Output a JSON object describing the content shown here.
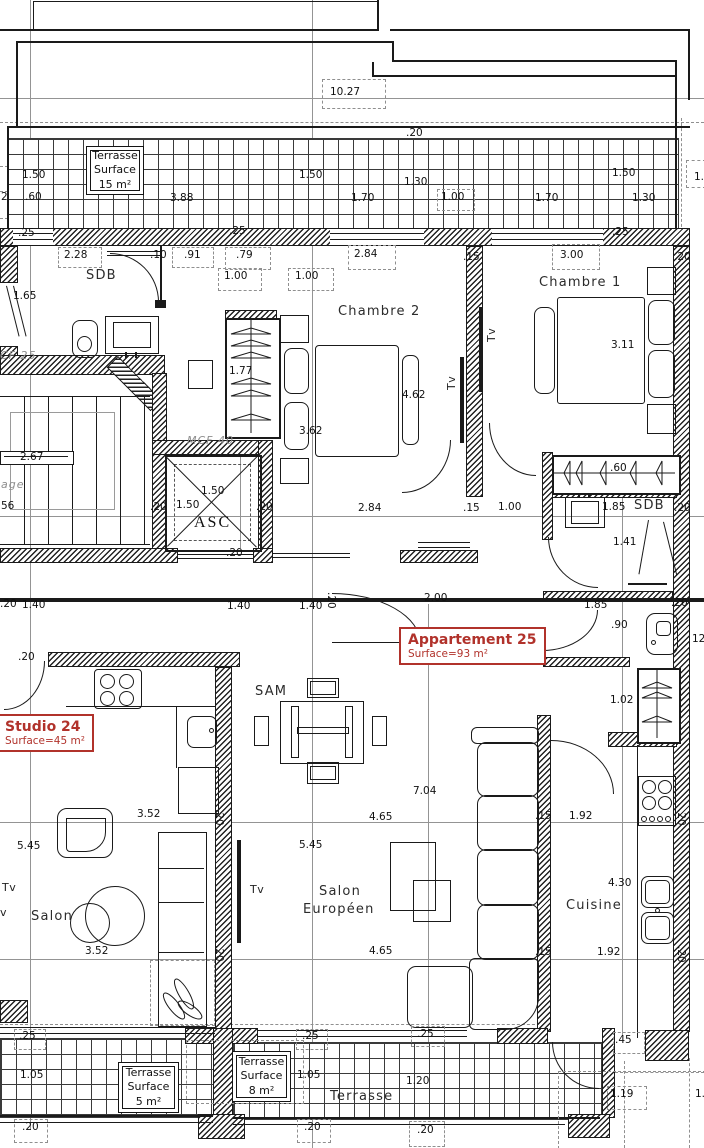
{
  "palette": {
    "line": "#1a1a1a",
    "gray": "#949494",
    "red": "#b1322b"
  },
  "apartments": [
    {
      "name": "Studio 24",
      "surface": "Surface=45 m²"
    },
    {
      "name": "Appartement 25",
      "surface": "Surface=93 m²"
    }
  ],
  "terraces": [
    {
      "name": "Terrasse",
      "surface_label": "Surface",
      "area": "15 m²"
    },
    {
      "name": "Terrasse",
      "surface_label": "Surface",
      "area": "5 m²"
    },
    {
      "name": "Terrasse",
      "surface_label": "Surface",
      "area": "8 m²"
    }
  ],
  "labels": [
    {
      "t": "10.27",
      "x": 330,
      "y": 87
    },
    {
      "t": ".20",
      "x": 406,
      "y": 128
    },
    {
      "t": "1.50",
      "x": 22,
      "y": 170
    },
    {
      "t": "1.50",
      "x": 299,
      "y": 170
    },
    {
      "t": "1.30",
      "x": 404,
      "y": 177
    },
    {
      "t": "1.50",
      "x": 612,
      "y": 168
    },
    {
      "t": "1.",
      "x": 694,
      "y": 172
    },
    {
      "t": "2",
      "x": 1,
      "y": 192
    },
    {
      "t": ".60",
      "x": 25,
      "y": 192
    },
    {
      "t": "3.88",
      "x": 170,
      "y": 193
    },
    {
      "t": "1.70",
      "x": 351,
      "y": 193
    },
    {
      "t": "1.00",
      "x": 441,
      "y": 192
    },
    {
      "t": "1.70",
      "x": 535,
      "y": 193
    },
    {
      "t": "1.30",
      "x": 632,
      "y": 193
    },
    {
      "t": ".25",
      "x": 18,
      "y": 228
    },
    {
      "t": ".25",
      "x": 229,
      "y": 226
    },
    {
      "t": ".25",
      "x": 612,
      "y": 227
    },
    {
      "t": "2.28",
      "x": 64,
      "y": 250
    },
    {
      "t": ".10",
      "x": 150,
      "y": 250
    },
    {
      "t": ".91",
      "x": 184,
      "y": 250
    },
    {
      "t": ".79",
      "x": 236,
      "y": 250
    },
    {
      "t": "2.84",
      "x": 354,
      "y": 249
    },
    {
      "t": "3.00",
      "x": 560,
      "y": 250
    },
    {
      "t": ".15",
      "x": 463,
      "y": 252
    },
    {
      "t": ".20",
      "x": 674,
      "y": 252
    },
    {
      "t": "1.00",
      "x": 224,
      "y": 271
    },
    {
      "t": "1.00",
      "x": 295,
      "y": 271
    },
    {
      "t": "1.65",
      "x": 13,
      "y": 291
    },
    {
      "t": "1.77",
      "x": 229,
      "y": 366
    },
    {
      "t": "3.62",
      "x": 299,
      "y": 426
    },
    {
      "t": "4.62",
      "x": 402,
      "y": 390
    },
    {
      "t": "3.11",
      "x": 611,
      "y": 340
    },
    {
      "t": "2.67",
      "x": 20,
      "y": 452
    },
    {
      "t": "age",
      "x": 1,
      "y": 479,
      "cls": "wall"
    },
    {
      "t": "56",
      "x": 1,
      "y": 501
    },
    {
      "t": "CF 25",
      "x": 0,
      "y": 350,
      "cls": "wall"
    },
    {
      "t": "MCF 40",
      "x": 187,
      "y": 435,
      "cls": "wall"
    },
    {
      "t": "1.50",
      "x": 201,
      "y": 486
    },
    {
      "t": "1.50",
      "x": 176,
      "y": 500
    },
    {
      "t": ".20",
      "x": 150,
      "y": 502
    },
    {
      "t": ".20",
      "x": 256,
      "y": 502
    },
    {
      "t": "2.84",
      "x": 358,
      "y": 503
    },
    {
      "t": ".15",
      "x": 463,
      "y": 503
    },
    {
      "t": "1.00",
      "x": 498,
      "y": 502
    },
    {
      "t": "1.85",
      "x": 602,
      "y": 502
    },
    {
      "t": ".20",
      "x": 674,
      "y": 503
    },
    {
      "t": ".60",
      "x": 610,
      "y": 463
    },
    {
      "t": "1.41",
      "x": 613,
      "y": 537
    },
    {
      "t": ".20",
      "x": 226,
      "y": 548
    },
    {
      "t": ".20",
      "x": 0,
      "y": 599
    },
    {
      "t": "1.40",
      "x": 22,
      "y": 600
    },
    {
      "t": "1.40",
      "x": 227,
      "y": 601
    },
    {
      "t": "1.40",
      "x": 299,
      "y": 601
    },
    {
      "t": ".20",
      "x": 336,
      "y": 592,
      "r": 90
    },
    {
      "t": "2.00",
      "x": 424,
      "y": 593
    },
    {
      "t": "1.85",
      "x": 584,
      "y": 600
    },
    {
      "t": ".20",
      "x": 671,
      "y": 598
    },
    {
      "t": ".90",
      "x": 611,
      "y": 620
    },
    {
      "t": "12",
      "x": 692,
      "y": 634
    },
    {
      "t": "1.02",
      "x": 610,
      "y": 695
    },
    {
      "t": ".20",
      "x": 18,
      "y": 652
    },
    {
      "t": "3.52",
      "x": 137,
      "y": 809
    },
    {
      "t": "5.45",
      "x": 17,
      "y": 841
    },
    {
      "t": "5.45",
      "x": 299,
      "y": 840
    },
    {
      "t": "7.04",
      "x": 413,
      "y": 786
    },
    {
      "t": "4.65",
      "x": 369,
      "y": 812
    },
    {
      "t": ".15",
      "x": 535,
      "y": 811
    },
    {
      "t": "1.92",
      "x": 569,
      "y": 811
    },
    {
      "t": ".20",
      "x": 686,
      "y": 809,
      "r": 90
    },
    {
      "t": "3.52",
      "x": 85,
      "y": 946
    },
    {
      "t": "4.65",
      "x": 369,
      "y": 946
    },
    {
      "t": ".15",
      "x": 535,
      "y": 947
    },
    {
      "t": "1.92",
      "x": 597,
      "y": 947
    },
    {
      "t": ".20",
      "x": 686,
      "y": 946,
      "r": 90
    },
    {
      "t": "4.30",
      "x": 608,
      "y": 878
    },
    {
      "t": ".20",
      "x": 224,
      "y": 809,
      "r": 90
    },
    {
      "t": ".20",
      "x": 224,
      "y": 945,
      "r": 90
    },
    {
      "t": ".25",
      "x": 19,
      "y": 1031
    },
    {
      "t": ".25",
      "x": 302,
      "y": 1031
    },
    {
      "t": ".25",
      "x": 417,
      "y": 1029
    },
    {
      "t": "1.05",
      "x": 20,
      "y": 1070
    },
    {
      "t": "1.05",
      "x": 297,
      "y": 1070
    },
    {
      "t": "1.20",
      "x": 406,
      "y": 1076
    },
    {
      "t": ".45",
      "x": 615,
      "y": 1035
    },
    {
      "t": "1.19",
      "x": 610,
      "y": 1089
    },
    {
      "t": "1.",
      "x": 695,
      "y": 1089
    },
    {
      "t": ".20",
      "x": 22,
      "y": 1122
    },
    {
      "t": ".20",
      "x": 304,
      "y": 1122
    },
    {
      "t": ".20",
      "x": 417,
      "y": 1125
    },
    {
      "t": "SDB",
      "x": 86,
      "y": 269,
      "cls": "room"
    },
    {
      "t": "Chambre 2",
      "x": 338,
      "y": 305,
      "cls": "room"
    },
    {
      "t": "Chambre 1",
      "x": 539,
      "y": 276,
      "cls": "room"
    },
    {
      "t": "SDB",
      "x": 634,
      "y": 499,
      "cls": "room"
    },
    {
      "t": "ASC",
      "x": 194,
      "y": 514,
      "cls": "serif"
    },
    {
      "t": "SAM",
      "x": 255,
      "y": 685,
      "cls": "room"
    },
    {
      "t": "Salon",
      "x": 31,
      "y": 910,
      "cls": "room"
    },
    {
      "t": "Salon",
      "x": 319,
      "y": 885,
      "cls": "room"
    },
    {
      "t": "Européen",
      "x": 303,
      "y": 903,
      "cls": "room"
    },
    {
      "t": "Cuisine",
      "x": 566,
      "y": 899,
      "cls": "room"
    },
    {
      "t": "Terrasse",
      "x": 330,
      "y": 1090,
      "cls": "room"
    },
    {
      "t": "Tv",
      "x": 446,
      "y": 390,
      "r": -90,
      "cls": "tv"
    },
    {
      "t": "Tv",
      "x": 486,
      "y": 342,
      "r": -90,
      "cls": "tv"
    },
    {
      "t": "Tv",
      "x": 2,
      "y": 882,
      "cls": "tv"
    },
    {
      "t": "v",
      "x": 0,
      "y": 907,
      "cls": "tv"
    },
    {
      "t": "Tv",
      "x": 250,
      "y": 884,
      "cls": "tv"
    }
  ]
}
